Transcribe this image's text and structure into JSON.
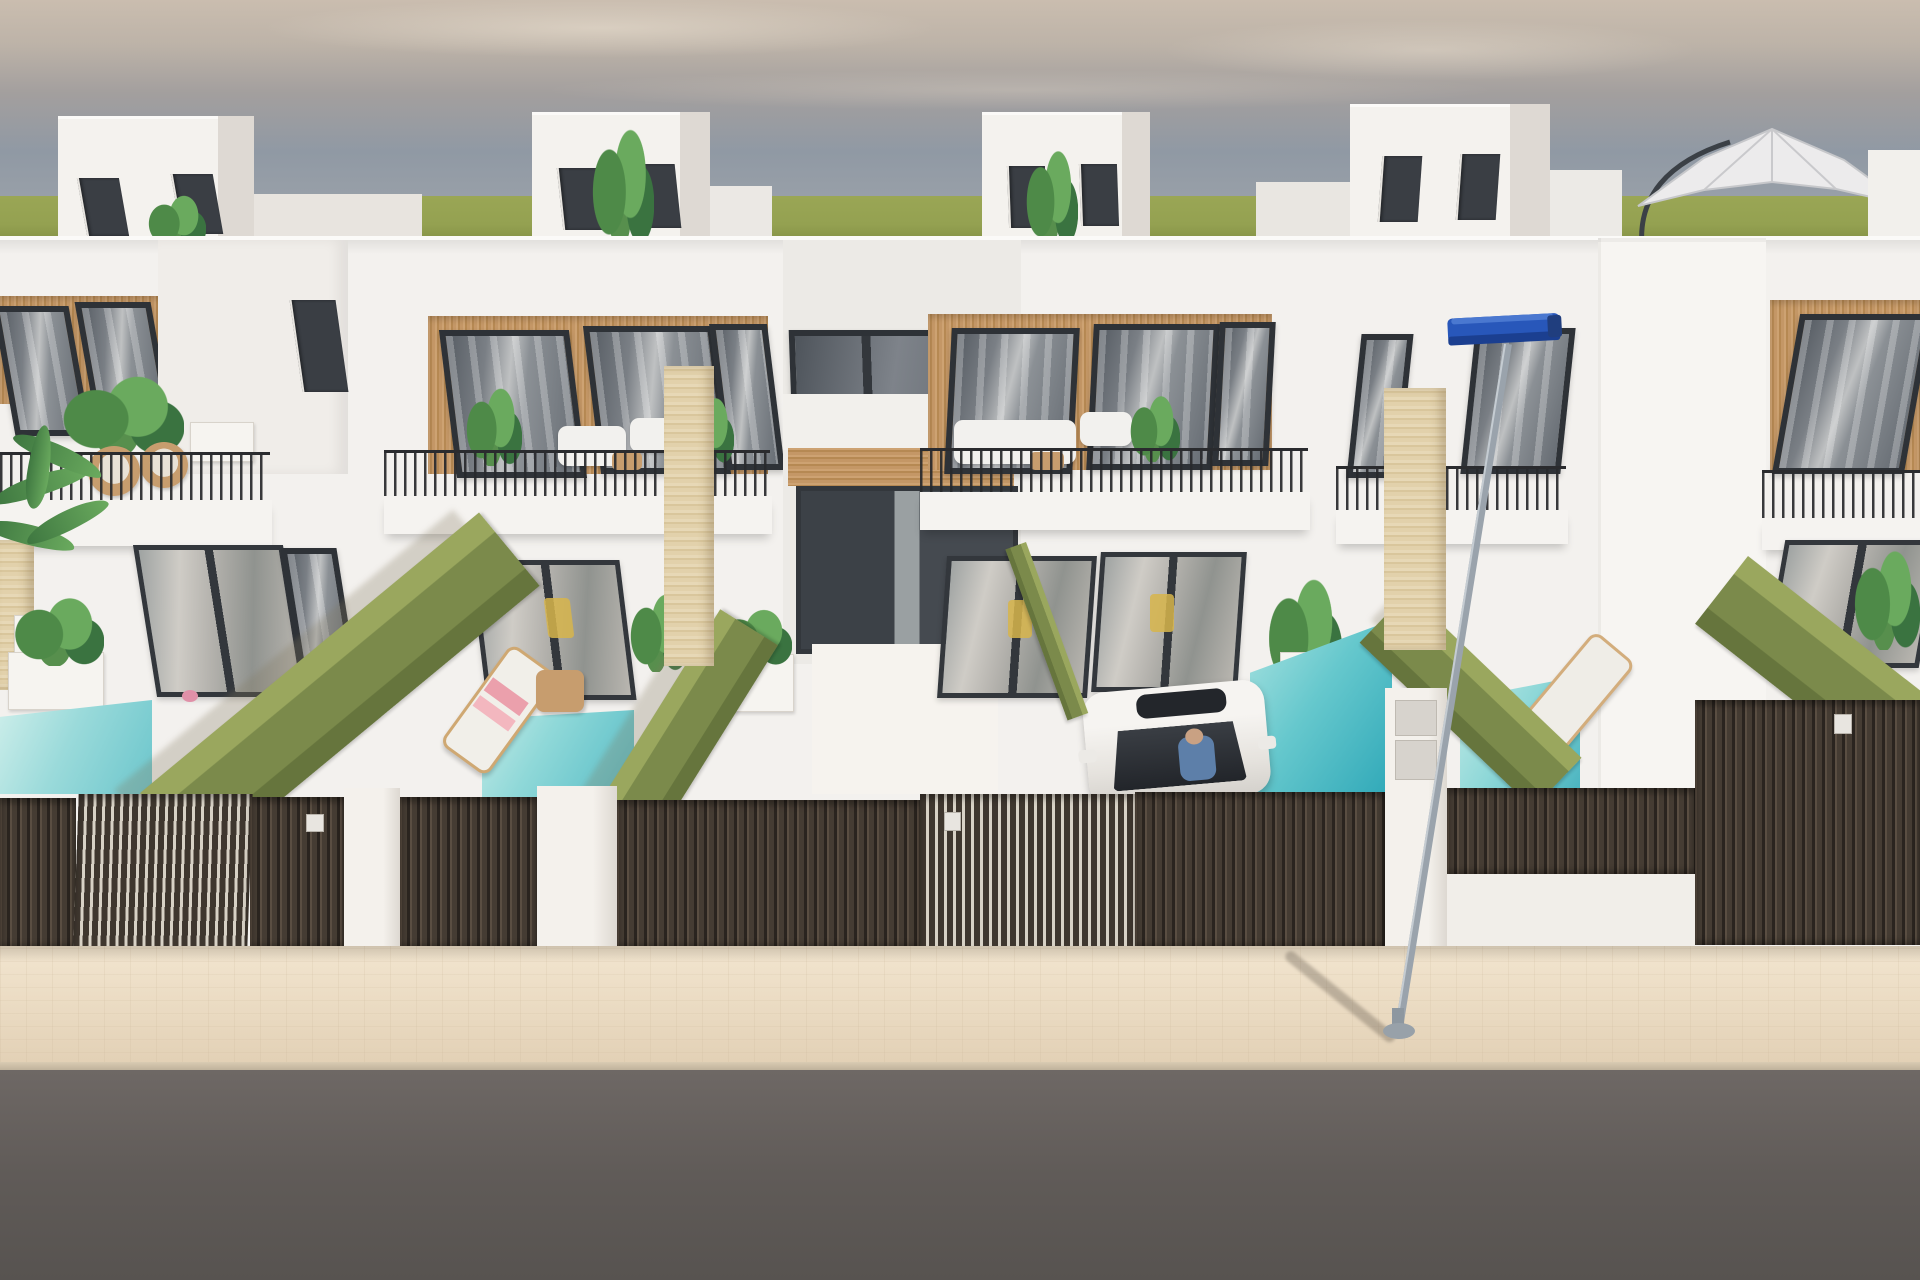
{
  "scene": {
    "title": "New-build modern townhouses street render",
    "type": "3d-architectural-render",
    "setting": "Row of white two-storey villas with wood-slat cladding, roof terraces, private pools and dark slatted street fences under a hazy sky",
    "counts": {
      "houses_visible": 4,
      "rooftop_boxes": 4,
      "pools_visible": 4,
      "cars": 1,
      "street_lamps": 1,
      "parasols": 1
    },
    "objects": [
      "sky",
      "grass-horizon",
      "rooftop-stair-box",
      "roof-parasol",
      "wood-cladding-panel",
      "upper-window",
      "balcony-railing",
      "balcony-sofa",
      "stone-pillar",
      "sliding-glass-door",
      "hedge-wall",
      "private-pool",
      "sun-lounger",
      "potted-plant",
      "white-car",
      "car-driver",
      "slatted-gate",
      "gate-intercom-plate",
      "mailbox-panels",
      "sidewalk",
      "asphalt-road",
      "street-lamp"
    ]
  },
  "palette": {
    "sky_top": "#cabdaf",
    "sky_mid": "#9099a4",
    "sky_low": "#a9aeb2",
    "cloud": "#ded3c4",
    "grass": "#94a151",
    "grass_dark": "#7f8c42",
    "wall": "#f3f1ee",
    "wall_bright": "#f7f5f2",
    "wall_shade": "#e2ddd6",
    "wood": "#c49766",
    "wood_dark": "#b68953",
    "frame": "#2e3237",
    "glass": "#7a7f85",
    "stone": "#e2d1ab",
    "stone_dark": "#d9c69c",
    "hedge": "#7b8a4b",
    "hedge_top": "#9aa75e",
    "hedge_dark": "#66753d",
    "pool_light": "#c2eae6",
    "pool": "#8fd8d8",
    "pool_deep": "#3fa9b8",
    "fence": "#453c33",
    "fence_hi": "#5a4e42",
    "fence_gap": "#2a241f",
    "fence_open": "#d8d2c6",
    "sidewalk": "#eedfc8",
    "road": "#6b6562",
    "car": "#efedea",
    "lamp_blue": "#2857ba",
    "lamp_dark": "#1b3f90",
    "pole": "#9aa3ac",
    "towel_pink": "#eba0ac",
    "rattan": "#c79d6e",
    "leaf": "#5c9553",
    "leaf_dark": "#3e7740",
    "chair_yellow": "#d7b54b"
  }
}
